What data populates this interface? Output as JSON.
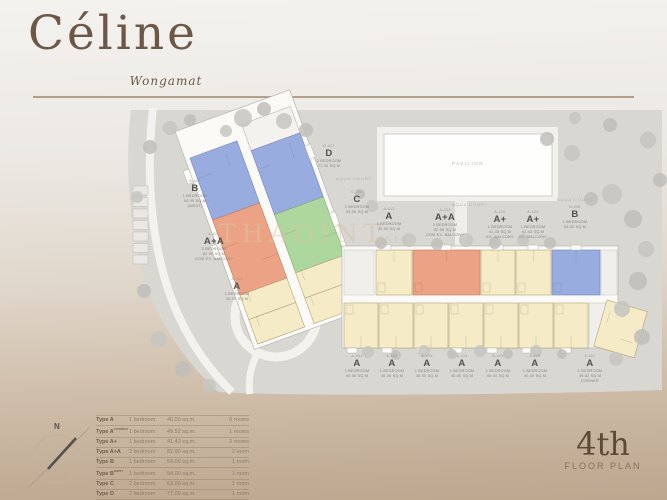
{
  "logo": {
    "brand": "Céline",
    "subtitle": "Wongamat"
  },
  "floor_mark": {
    "number": "4th",
    "label": "FLOOR PLAN"
  },
  "plan": {
    "pavilion_label": "PAVILION",
    "court_labels": [
      "AQUA COURT",
      "AQUA COURT",
      "AQUA COURT"
    ],
    "watermark": "THAOINT",
    "watermark_2": "ASIA",
    "compass_north": "N",
    "unit_labels": [
      {
        "code": "D-417",
        "letter": "D",
        "desc": [
          "2 BEDROOM",
          "77.00 SQ.M"
        ]
      },
      {
        "code": "C-416",
        "letter": "C",
        "desc": [
          "2 BEDROOM",
          "63.00 SQ.M"
        ]
      },
      {
        "code": "B-415",
        "letter": "B",
        "desc": [
          "1 BEDROOM",
          "54.00 SQ.M",
          "(WEST)"
        ]
      },
      {
        "code": "A-414",
        "letter": "A+A",
        "desc": [
          "2 BEDROOM",
          "82.90 SQ.M",
          "COM EX. BALCONY"
        ]
      },
      {
        "code": "A-413",
        "letter": "A",
        "desc": [
          "1 BEDROOM",
          "40.00 SQ.M"
        ]
      },
      {
        "code": "A-412",
        "letter": "A",
        "desc": [
          "1 BEDROOM",
          "40.00 SQ.M"
        ]
      },
      {
        "code": "A-411",
        "letter": "A+A",
        "desc": [
          "2 BEDROOM",
          "82.90 SQ.M",
          "COM EX. BALCONY"
        ]
      },
      {
        "code": "A-410",
        "letter": "A+",
        "desc": [
          "1 BEDROOM",
          "41.43 SQ.M",
          "EX. BALCONY"
        ]
      },
      {
        "code": "A-409",
        "letter": "A+",
        "desc": [
          "1 BEDROOM",
          "41.43 SQ.M",
          "EX. BALCONY"
        ]
      },
      {
        "code": "B-408",
        "letter": "B",
        "desc": [
          "1 BEDROOM",
          "54.00 SQ.M"
        ]
      },
      {
        "code": "A-401",
        "letter": "A",
        "desc": [
          "1 BEDROOM",
          "40.00 SQ.M"
        ]
      },
      {
        "code": "A-402",
        "letter": "A",
        "desc": [
          "1 BEDROOM",
          "40.00 SQ.M"
        ]
      },
      {
        "code": "A-403",
        "letter": "A",
        "desc": [
          "1 BEDROOM",
          "40.00 SQ.M"
        ]
      },
      {
        "code": "A-404",
        "letter": "A",
        "desc": [
          "1 BEDROOM",
          "40.00 SQ.M"
        ]
      },
      {
        "code": "A-405",
        "letter": "A",
        "desc": [
          "1 BEDROOM",
          "40.00 SQ.M"
        ]
      },
      {
        "code": "A-406",
        "letter": "A",
        "desc": [
          "1 BEDROOM",
          "40.00 SQ.M"
        ]
      },
      {
        "code": "A-407",
        "letter": "A",
        "desc": [
          "1 BEDROOM",
          "49.52 SQ.M",
          "CORNER"
        ]
      }
    ]
  },
  "legend": {
    "rows": [
      {
        "type": "Type A",
        "suffix": "",
        "bedroom": "1 bedroom",
        "area": "40.00 sq.m.",
        "rooms": "8 rooms"
      },
      {
        "type": "Type A",
        "suffix": "CORNER",
        "bedroom": "1 bedroom",
        "area": "49.52 sq.m.",
        "rooms": "1 rooms"
      },
      {
        "type": "Type A+",
        "suffix": "",
        "bedroom": "1 bedroom",
        "area": "41.43 sq.m.",
        "rooms": "2 rooms"
      },
      {
        "type": "Type A+A",
        "suffix": "",
        "bedroom": "2 bedroom",
        "area": "82.90 sq.m.",
        "rooms": "2 room"
      },
      {
        "type": "Type B",
        "suffix": "",
        "bedroom": "1 bedroom",
        "area": "54.00 sq.m.",
        "rooms": "1 room"
      },
      {
        "type": "Type B",
        "suffix": "WEST",
        "bedroom": "1 bedroom",
        "area": "54.00 sq.m.",
        "rooms": "1 room"
      },
      {
        "type": "Type C",
        "suffix": "",
        "bedroom": "2 bedroom",
        "area": "63.00 sq.m.",
        "rooms": "1 room"
      },
      {
        "type": "Type D",
        "suffix": "",
        "bedroom": "2 bedroom",
        "area": "77.00 sq.m.",
        "rooms": "1 room"
      }
    ]
  }
}
